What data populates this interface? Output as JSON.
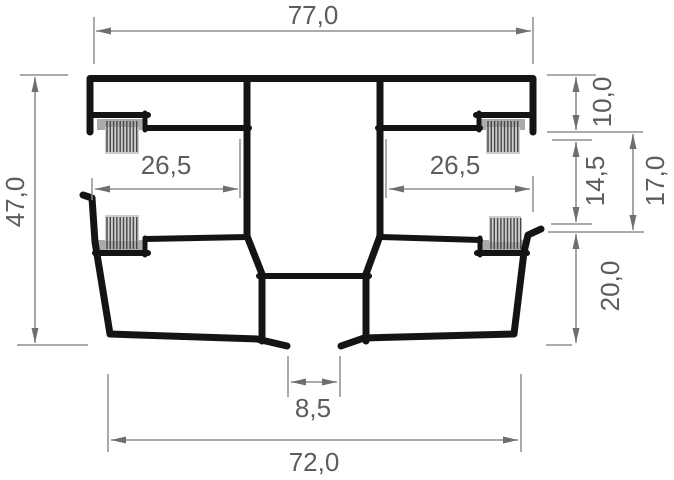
{
  "drawing": {
    "kind": "profile-cross-section",
    "dimensions": {
      "top_width": {
        "label": "77,0",
        "value": 77.0,
        "orientation": "horizontal",
        "position": "top"
      },
      "overall_height": {
        "label": "47,0",
        "value": 47.0,
        "orientation": "vertical",
        "position": "left"
      },
      "left_track_width": {
        "label": "26,5",
        "value": 26.5,
        "orientation": "horizontal",
        "position": "middle-left"
      },
      "right_track_width": {
        "label": "26,5",
        "value": 26.5,
        "orientation": "horizontal",
        "position": "middle-right"
      },
      "upper_wall_height": {
        "label": "10,0",
        "value": 10.0,
        "orientation": "vertical",
        "position": "right"
      },
      "track_opening_height": {
        "label": "14,5",
        "value": 14.5,
        "orientation": "vertical",
        "position": "right"
      },
      "track_total_height": {
        "label": "17,0",
        "value": 17.0,
        "orientation": "vertical",
        "position": "right"
      },
      "lower_chamber_height": {
        "label": "20,0",
        "value": 20.0,
        "orientation": "vertical",
        "position": "right"
      },
      "bottom_slot_width": {
        "label": "8,5",
        "value": 8.5,
        "orientation": "horizontal",
        "position": "bottom-center"
      },
      "bottom_width": {
        "label": "72,0",
        "value": 72.0,
        "orientation": "horizontal",
        "position": "bottom"
      }
    },
    "features": {
      "brush_seals": [
        "upper-left",
        "upper-right",
        "lower-left",
        "lower-right"
      ]
    },
    "colors": {
      "profile_outline": "#141414",
      "dimension_lines": "#8f8f8f",
      "dimension_text": "#5d5d5d",
      "brush_backing": "#ababab",
      "brush_pile": "#cdcdcd",
      "background": "#ffffff"
    }
  }
}
